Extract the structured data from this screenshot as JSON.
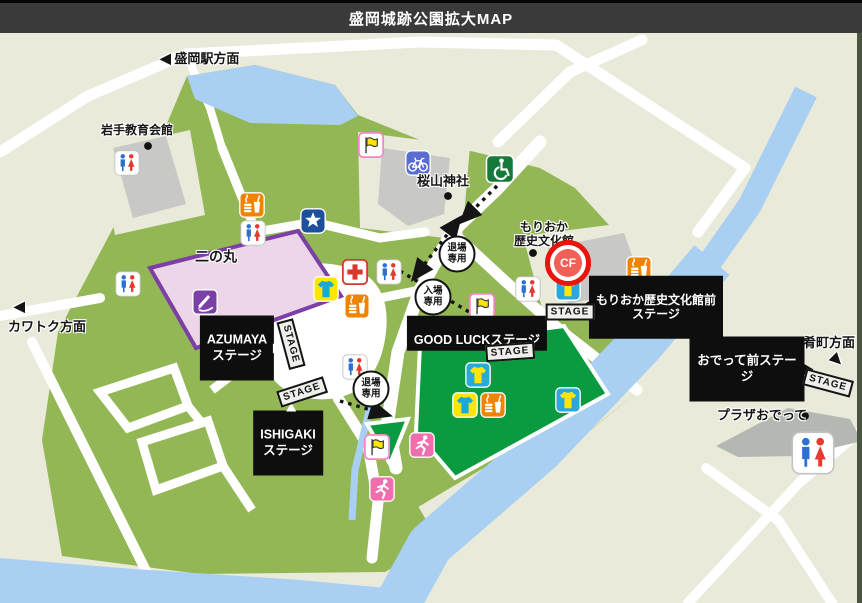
{
  "header": {
    "title": "盛岡城跡公園拡大MAP"
  },
  "labels": {
    "station_dir": "盛岡駅方面",
    "kawatoku_dir": "カワトク方面",
    "sakanacho_dir": "肴町方面",
    "arrow_left": "◀",
    "arrow_se": "▶",
    "iwate_kyoiku": "岩手教育会館",
    "sakurayama": "桜山神社",
    "rekishi_bunkakan": "もりおか\n歴史文化館",
    "ninomaru": "二の丸",
    "plaza_odette": "プラザおでって",
    "azumaya": "AZUMAYA\nステージ",
    "ishigaki": "ISHIGAKI\nステージ",
    "goodluck": "GOOD LUCKステージ",
    "rekishi_mae": "もりおか歴史文化館前\nステージ",
    "odette_mae": "おでって前ステージ",
    "stage_sign": "STAGE",
    "entry": "入場\n専用",
    "exit": "退場\n専用",
    "cf": "CF"
  },
  "colors": {
    "header_bg": "#3a3a3a",
    "map_bg": "#e9ead9",
    "park_green": "#93b755",
    "stage_green": "#0a9a40",
    "water_blue": "#a9d0f2",
    "building_gray": "#c8c8c6",
    "ninomaru_fill": "#eed6e9",
    "ninomaru_border": "#7b3fa5",
    "highlight_red": "#e8150c"
  },
  "map": {
    "icons": [
      {
        "t": "flag",
        "x": 371,
        "y": 145
      },
      {
        "t": "bicycle",
        "x": 418,
        "y": 163
      },
      {
        "t": "wheelchair",
        "x": 500,
        "y": 169,
        "s": 30
      },
      {
        "t": "toilet",
        "x": 127,
        "y": 163
      },
      {
        "t": "food",
        "x": 252,
        "y": 205
      },
      {
        "t": "toilet",
        "x": 253,
        "y": 233
      },
      {
        "t": "star",
        "x": 313,
        "y": 221
      },
      {
        "t": "toilet",
        "x": 128,
        "y": 284
      },
      {
        "t": "firstaid",
        "x": 355,
        "y": 272
      },
      {
        "t": "toilet",
        "x": 389,
        "y": 272
      },
      {
        "t": "tshirt-a",
        "x": 326,
        "y": 289
      },
      {
        "t": "food",
        "x": 357,
        "y": 306
      },
      {
        "t": "toilet",
        "x": 528,
        "y": 289
      },
      {
        "t": "tshirt-b",
        "x": 568,
        "y": 288
      },
      {
        "t": "food",
        "x": 639,
        "y": 269
      },
      {
        "t": "flag",
        "x": 482,
        "y": 306
      },
      {
        "t": "tshirt-b",
        "x": 478,
        "y": 375
      },
      {
        "t": "tshirt-a",
        "x": 465,
        "y": 405
      },
      {
        "t": "food",
        "x": 493,
        "y": 405
      },
      {
        "t": "tshirt-b",
        "x": 568,
        "y": 400
      },
      {
        "t": "runner",
        "x": 422,
        "y": 445
      },
      {
        "t": "flag",
        "x": 377,
        "y": 447
      },
      {
        "t": "runner",
        "x": 382,
        "y": 489
      },
      {
        "t": "toilet",
        "x": 355,
        "y": 367
      },
      {
        "t": "stamp",
        "x": 205,
        "y": 302
      },
      {
        "t": "toilet",
        "x": 813,
        "y": 453,
        "s": 46
      },
      {
        "t": "dot",
        "x": 148,
        "y": 146,
        "s": 13
      },
      {
        "t": "dot",
        "x": 448,
        "y": 196,
        "s": 13
      },
      {
        "t": "dot",
        "x": 533,
        "y": 253,
        "s": 13
      },
      {
        "t": "dot",
        "x": 805,
        "y": 416,
        "s": 13
      }
    ]
  }
}
